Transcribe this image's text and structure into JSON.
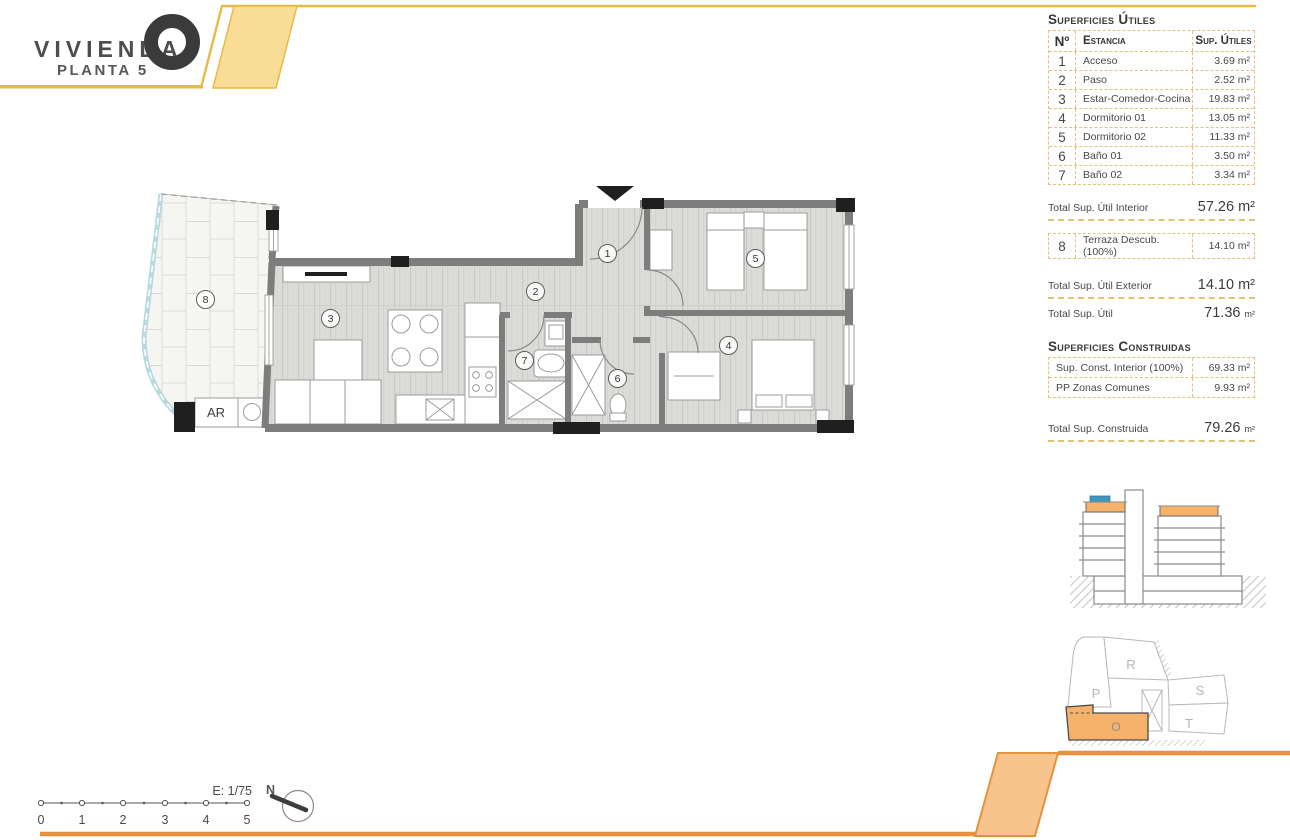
{
  "header": {
    "project": "VIVIENDA",
    "floor": "PLANTA 5"
  },
  "tables": {
    "utiles": {
      "title": "Superficies Útiles",
      "columns": {
        "num": "Nº",
        "room": "Estancia",
        "area": "Sup. Útiles"
      },
      "rows": [
        {
          "n": "1",
          "room": "Acceso",
          "area": "3.69 m²"
        },
        {
          "n": "2",
          "room": "Paso",
          "area": "2.52 m²"
        },
        {
          "n": "3",
          "room": "Estar-Comedor-Cocina",
          "area": "19.83 m²"
        },
        {
          "n": "4",
          "room": "Dormitorio 01",
          "area": "13.05 m²"
        },
        {
          "n": "5",
          "room": "Dormitorio 02",
          "area": "11.33 m²"
        },
        {
          "n": "6",
          "room": "Baño 01",
          "area": "3.50 m²"
        },
        {
          "n": "7",
          "room": "Baño 02",
          "area": "3.34 m²"
        }
      ],
      "total_interior": {
        "label": "Total Sup. Útil Interior",
        "value": "57.26 m²"
      },
      "terraza": {
        "n": "8",
        "room": "Terraza Descub.(100%)",
        "area": "14.10 m²"
      },
      "total_exterior": {
        "label": "Total Sup. Útil Exterior",
        "value": "14.10 m²"
      },
      "total": {
        "label": "Total Sup. Útil",
        "value": "71.36",
        "unit": "m²"
      }
    },
    "construidas": {
      "title": "Superficies Construidas",
      "rows": [
        {
          "label": "Sup. Const. Interior (100%)",
          "value": "69.33 m²"
        },
        {
          "label": "PP Zonas Comunes",
          "value": "9.93 m²"
        }
      ],
      "total": {
        "label": "Total Sup. Construida",
        "value": "79.26",
        "unit": "m²"
      }
    }
  },
  "plan": {
    "rooms": [
      "1",
      "2",
      "3",
      "4",
      "5",
      "6",
      "7",
      "8"
    ],
    "ar_label": "AR"
  },
  "scalebar": {
    "label": "E: 1/75",
    "ticks": [
      "0",
      "1",
      "2",
      "3",
      "4",
      "5"
    ]
  },
  "compass": {
    "north": "N"
  },
  "siteplan": {
    "p": "P",
    "r": "R",
    "s": "S",
    "t": "T",
    "o": "O"
  },
  "colors": {
    "accent_yellow": "#f9dc96",
    "accent_yellow_border": "#e7ba45",
    "accent_orange": "#f8c48e",
    "accent_orange_border": "#e8913c",
    "total_orange": "#efa14c"
  }
}
